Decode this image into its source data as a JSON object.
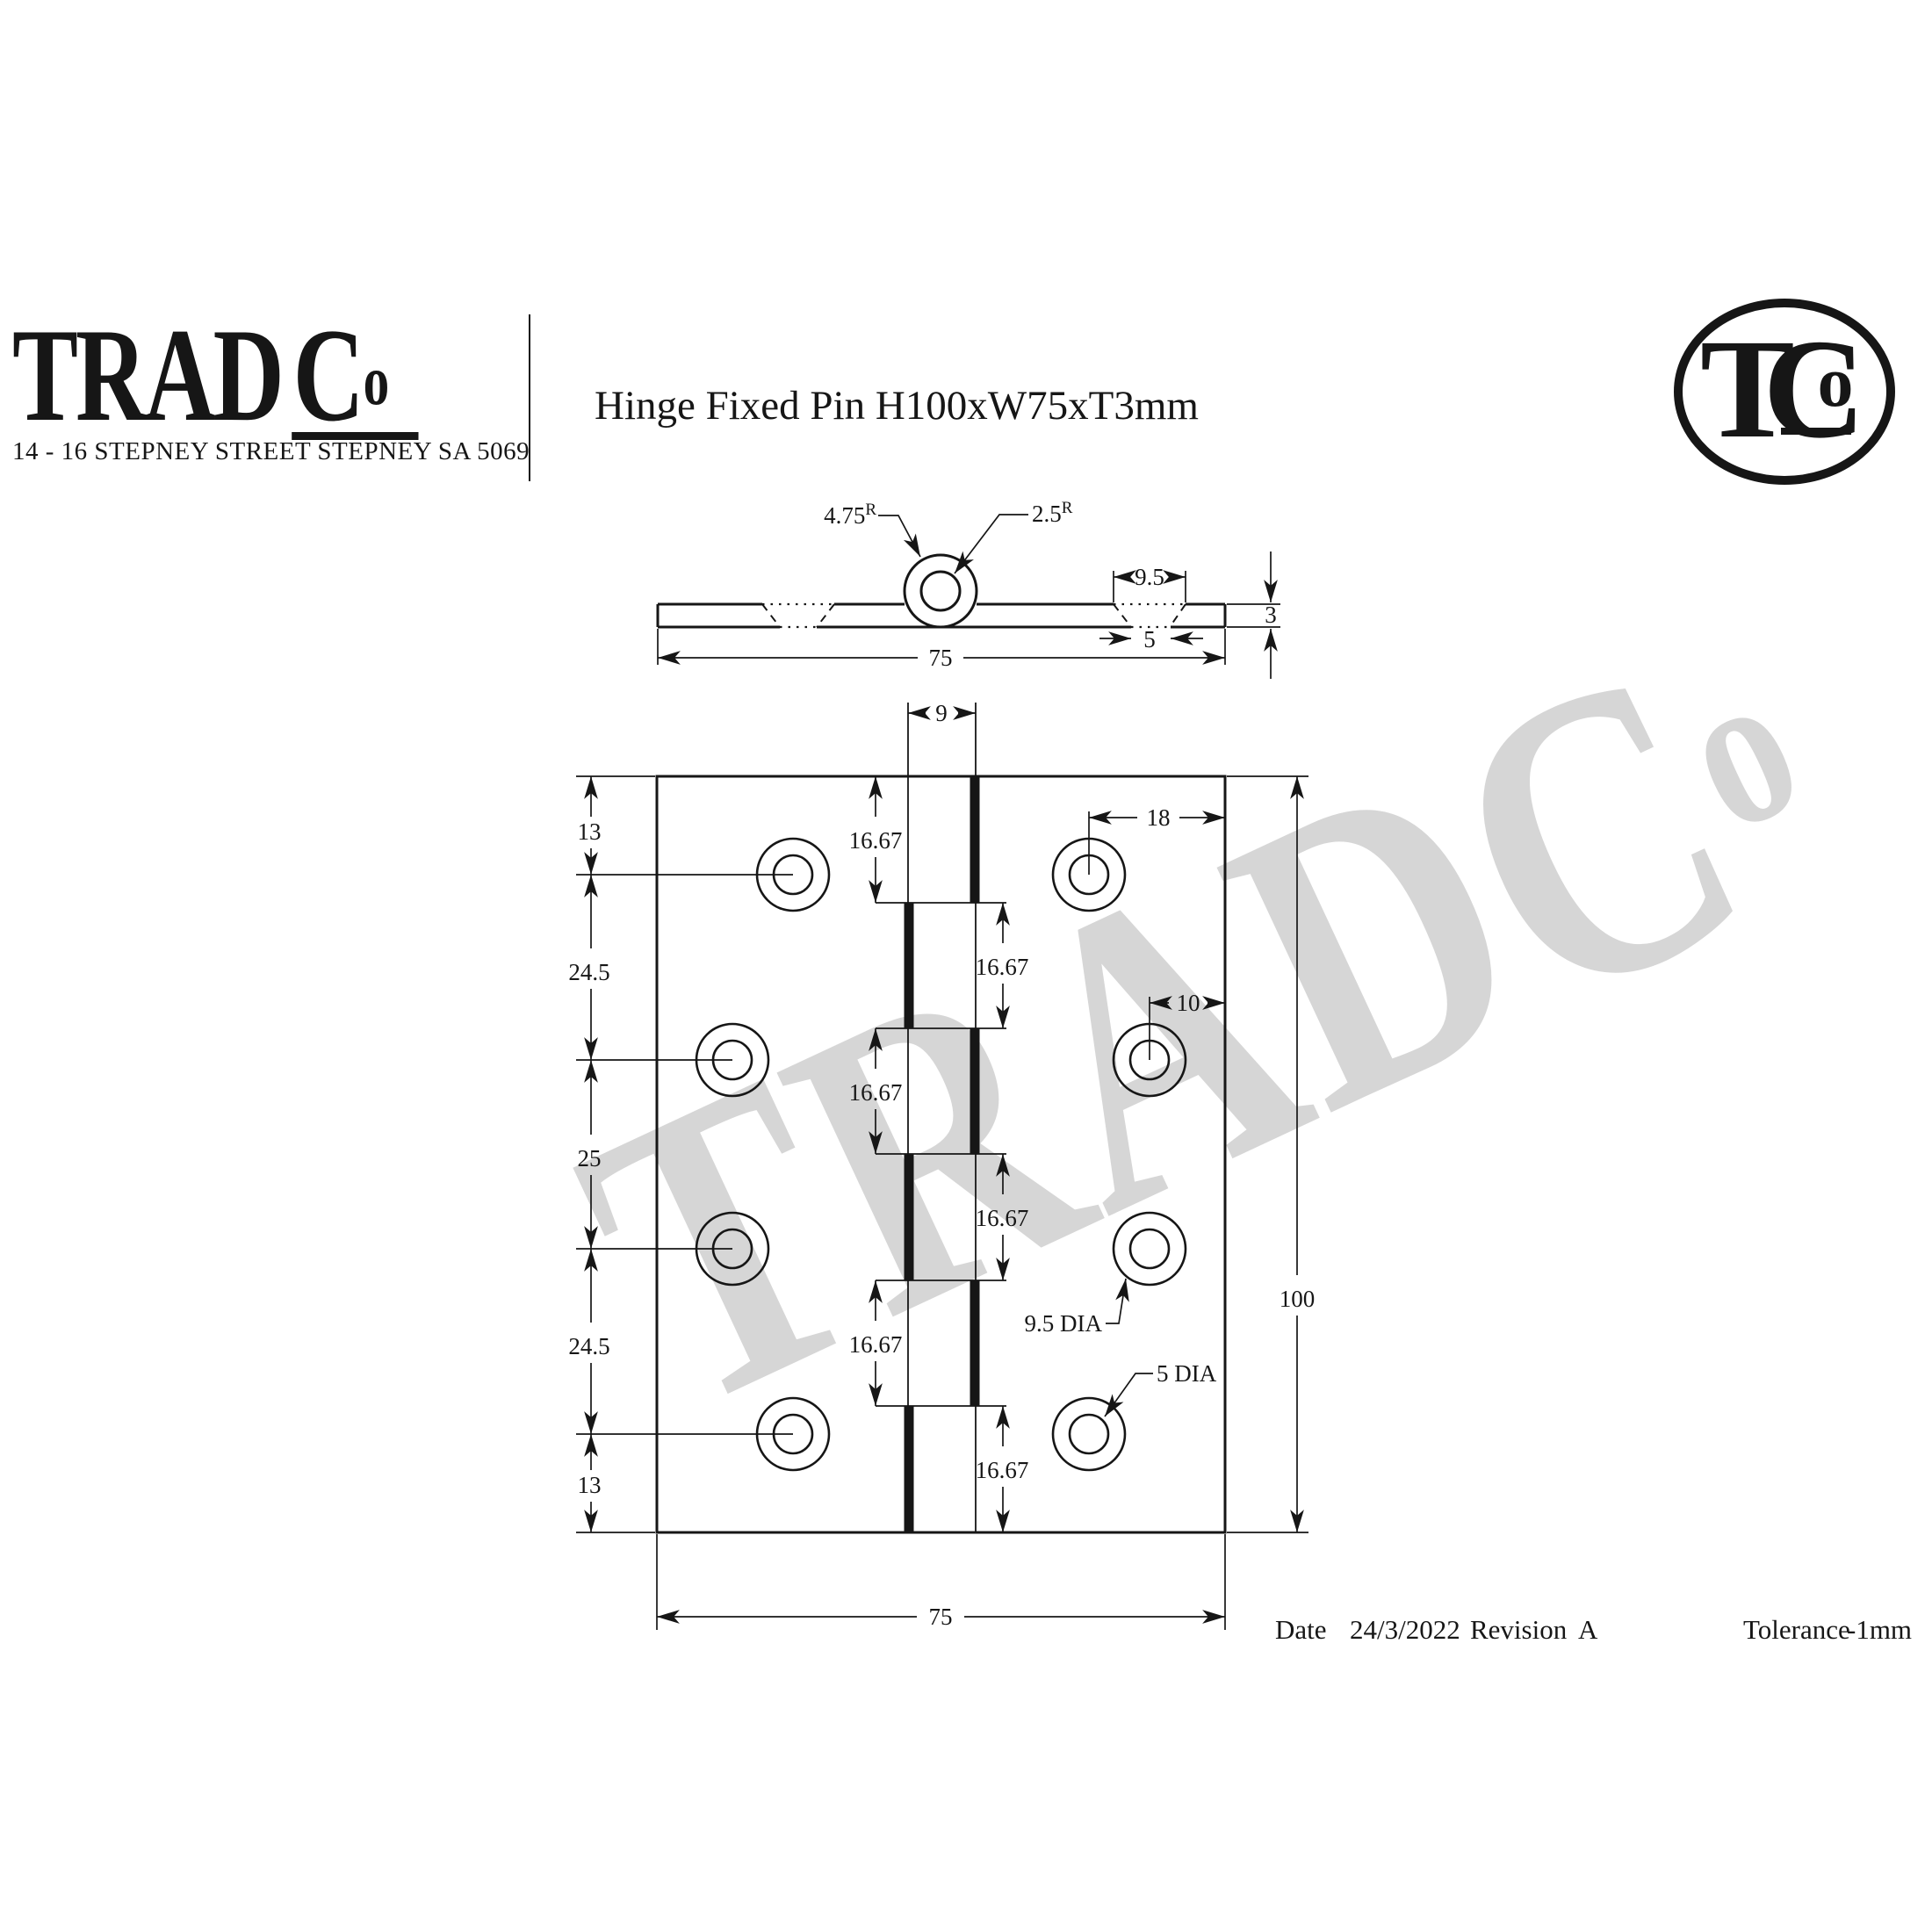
{
  "header": {
    "logo": {
      "name_main": "TRAD",
      "name_c": "C",
      "name_o": "o",
      "address": "14 - 16 STEPNEY STREET STEPNEY SA 5069"
    },
    "title": "Hinge Fixed Pin H100xW75xT3mm",
    "badge": {
      "t": "T",
      "c": "C",
      "o": "o"
    }
  },
  "watermark": {
    "main": "TRADC",
    "o": "o"
  },
  "section_view": {
    "outer_radius": "4.75",
    "outer_radius_sup": "R",
    "inner_radius": "2.5",
    "inner_radius_sup": "R",
    "countersink_top_width": "9.5",
    "countersink_bottom_width": "5",
    "thickness": "3",
    "overall_width": "75"
  },
  "front_view": {
    "knuckle_width": "9",
    "segment_dims": [
      "16.67",
      "16.67",
      "16.67",
      "16.67",
      "16.67",
      "16.67"
    ],
    "left_chain": [
      "13",
      "24.5",
      "25",
      "24.5",
      "13"
    ],
    "hole_offset_top": "18",
    "hole_offset_mid": "10",
    "overall_height": "100",
    "overall_width": "75",
    "countersink_dia_label": "9.5 DIA",
    "hole_dia_label": "5 DIA"
  },
  "footer": {
    "date_label": "Date",
    "date_value": "24/3/2022",
    "revision_label": "Revision",
    "revision_value": "A",
    "tolerance_label": "Tolerance",
    "tolerance_value": "-1mm"
  }
}
